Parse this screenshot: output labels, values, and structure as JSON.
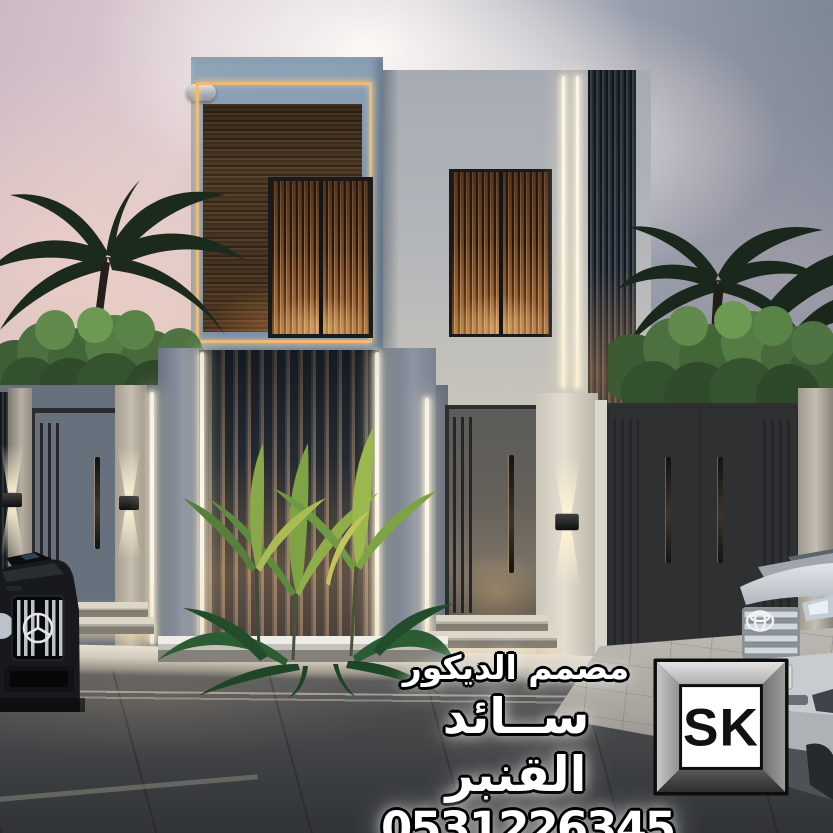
{
  "meta": {
    "category": "architectural-exterior-render-advertisement",
    "language": "ar"
  },
  "overlay": {
    "profession_title": "مصمم الديكور",
    "designer_name": "ســائد القنبر",
    "phone_number": "0531226345",
    "logo_text": "SK"
  },
  "scene": {
    "description": "Dusk 3D render of a modern two-storey villa: blue-grey and light stucco walls, dark wood cladding panel framed by a golden LED strip, warm vertically-slatted windows, white LED strip lights, dark metal pedestrian and garage gates with long handles, up/down wall sconces, green hedges and dark palm silhouettes, tropical planter, dark SUV at left and light SUV at right, asphalt driveway in front",
    "colors": {
      "sky_warm": "#e8cdbb",
      "sky_cool": "#76818f",
      "wall_blue": "#8297ac",
      "wall_light": "#d6d0c3",
      "wood": "#49372a",
      "led_gold": "#edb977",
      "led_white": "#fdf7e9",
      "window_glow": "#c08354",
      "gate_metal": "#56544f",
      "hedge_green": "#4c7040",
      "palm_dark": "#1c2a1e",
      "asphalt": "#3c3f41",
      "text_fill": "#ffffff",
      "text_outline": "#000000"
    }
  }
}
